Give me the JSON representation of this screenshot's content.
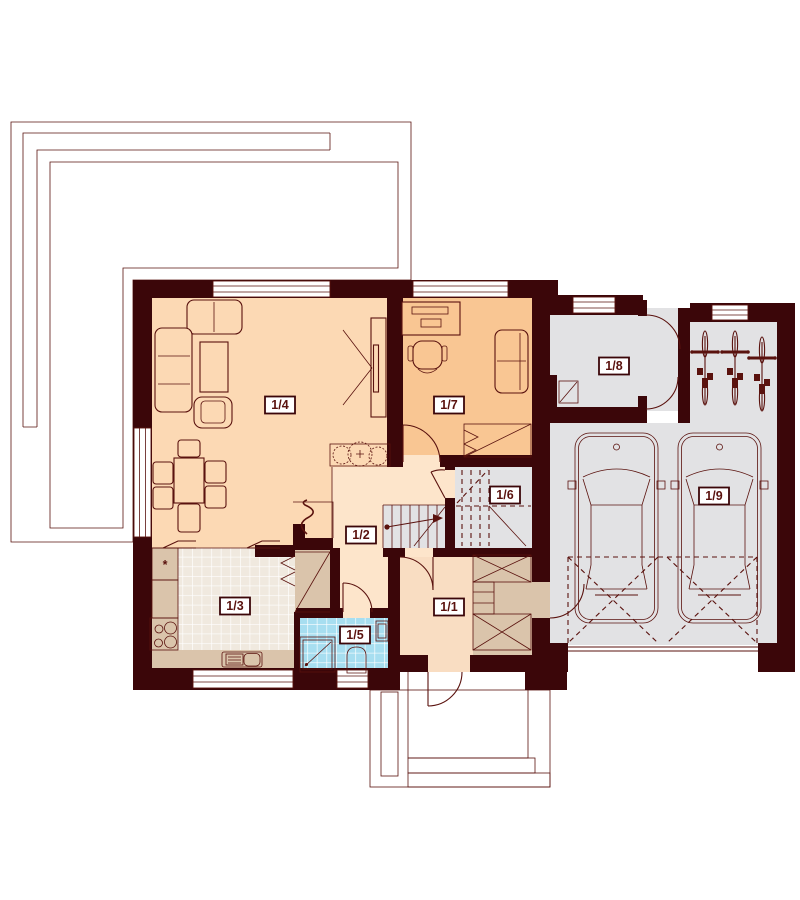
{
  "palette": {
    "wall": "#3b0609",
    "line": "#5a120e",
    "living_floor": "#fcd9b4",
    "office_floor": "#f9c693",
    "hall_floor": "#fde5cb",
    "entry_floor": "#f9ddc2",
    "closet_tan": "#dac4ab",
    "fridge_beige": "#eeddc4",
    "kitchen_tile": "#f0e9df",
    "bath_tile": "#a7def0",
    "gray_floor": "#e2e2e4",
    "terrace_gray": "#e0e0e2",
    "column_gray": "#c9ccd1",
    "label_bg": "#ffffff"
  },
  "rooms": [
    {
      "label": "1/1"
    },
    {
      "label": "1/2"
    },
    {
      "label": "1/3"
    },
    {
      "label": "1/4"
    },
    {
      "label": "1/5"
    },
    {
      "label": "1/6"
    },
    {
      "label": "1/7"
    },
    {
      "label": "1/8"
    },
    {
      "label": "1/9"
    }
  ],
  "symbols": {
    "fridge_asterisk": "*"
  }
}
